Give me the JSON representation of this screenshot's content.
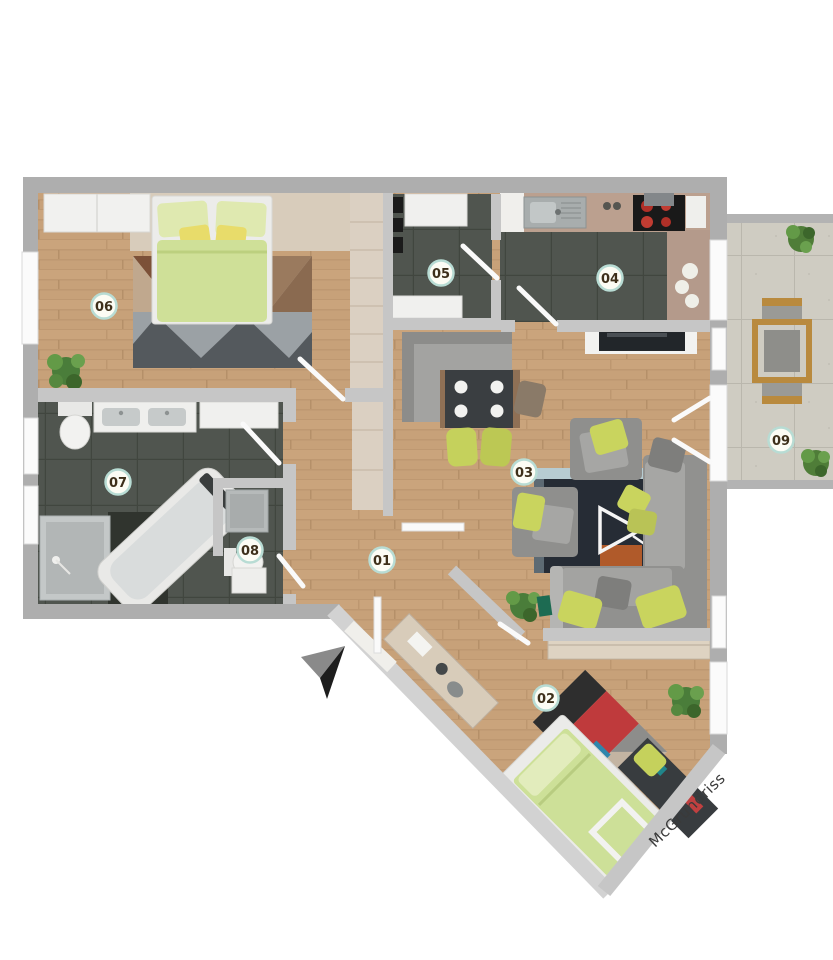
{
  "watermark": {
    "text": "McGrundriss"
  },
  "rooms": [
    {
      "number": "01"
    },
    {
      "number": "02"
    },
    {
      "number": "03"
    },
    {
      "number": "04"
    },
    {
      "number": "05"
    },
    {
      "number": "06"
    },
    {
      "number": "07"
    },
    {
      "number": "08"
    },
    {
      "number": "09"
    }
  ],
  "icons": [
    {
      "name": "north-arrow"
    },
    {
      "name": "play-triangle-rug-logo"
    }
  ],
  "colors": {
    "wood_floor": "#c7a179",
    "dark_tile": "#50554f",
    "balcony_tile": "#cfccc2",
    "outer_wall": "#aeaeae",
    "inner_wall": "#c6c6c6",
    "accent_green": "#c9d45e",
    "bed_green": "#cfe098",
    "label_ring": "#b8dcd4",
    "label_text": "#3d2f1a",
    "counter": "#bba08f",
    "rug_dark": "#262c35",
    "rug_red": "#bf3a3c"
  }
}
